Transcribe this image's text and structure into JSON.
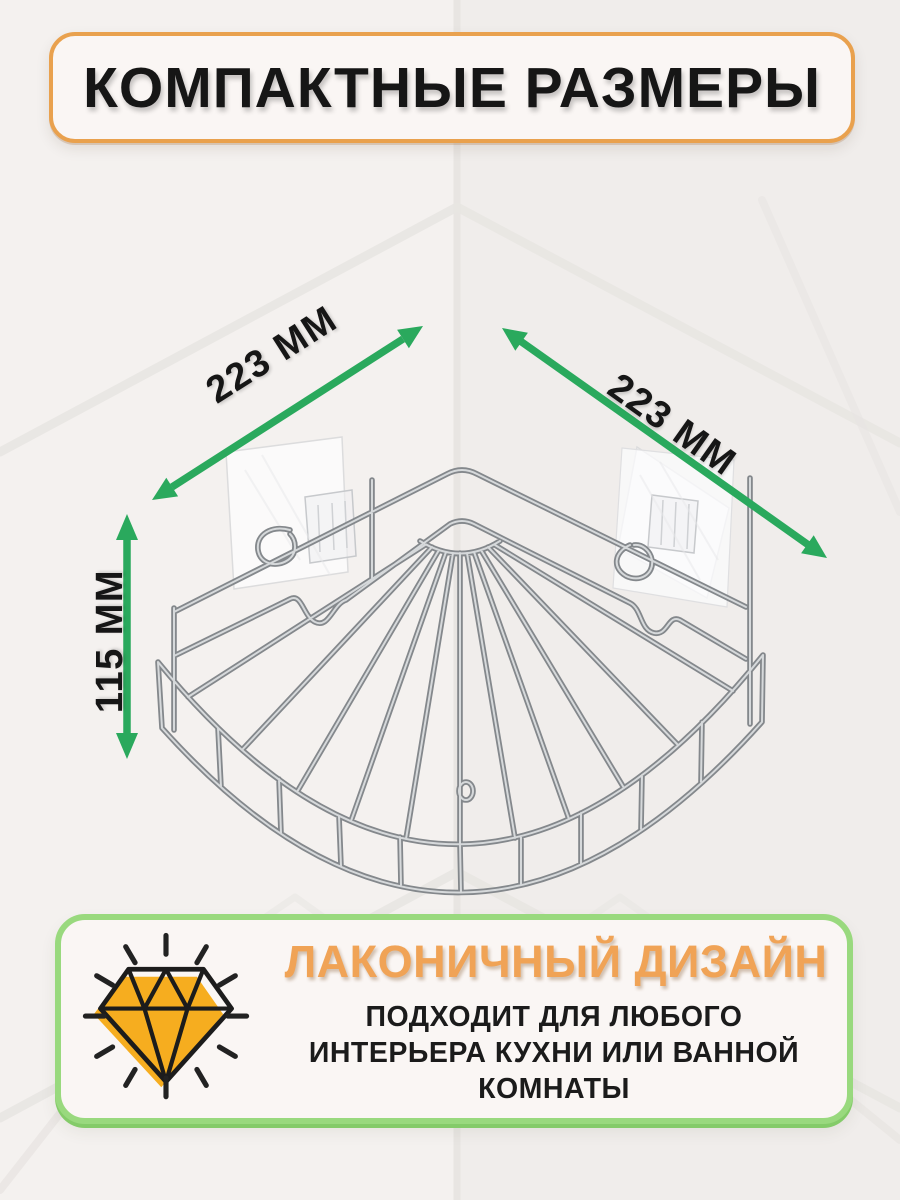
{
  "banner": {
    "title": "КОМПАКТНЫЕ РАЗМЕРЫ"
  },
  "dimensions": {
    "width_left": "223 ММ",
    "width_right": "223 ММ",
    "height": "115 ММ"
  },
  "feature_card": {
    "heading": "ЛАКОНИЧНЫЙ ДИЗАЙН",
    "description_line1": "ПОДХОДИТ ДЛЯ ЛЮБОГО",
    "description_line2": "ИНТЕРЬЕРА КУХНИ ИЛИ ВАННОЙ",
    "description_line3": "КОМНАТЫ",
    "icon": "diamond-sparkle-icon"
  },
  "illustration": {
    "subject": "chrome-corner-wire-shelf",
    "mounts": "adhesive-pads"
  },
  "colors": {
    "orange_border": "#E9A14E",
    "heading_orange": "#F0A356",
    "arrow_green": "#2AA95D",
    "card_border_green": "#99D97E",
    "card_border_green_dark": "#84CB69",
    "diamond_yellow": "#F6AD1F",
    "ink": "#161616",
    "page_bg": "#f4f1ef",
    "panel_bg": "#faf6f4"
  }
}
